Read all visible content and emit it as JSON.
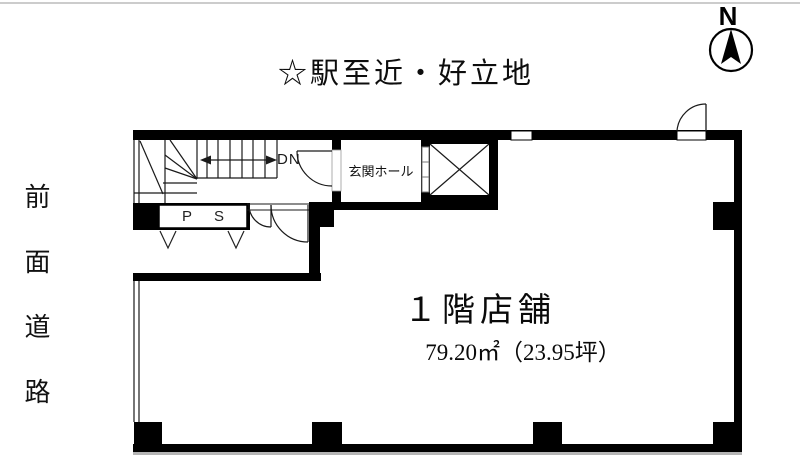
{
  "header": {
    "title": "☆駅至近・好立地"
  },
  "compass": {
    "label": "N"
  },
  "road_label": {
    "text": "前面道路"
  },
  "stairwell": {
    "direction_label": "DN",
    "pipe_space_label": "P S"
  },
  "entrance": {
    "hall_label": "玄関ホール"
  },
  "shop": {
    "name": "１階店舗",
    "area": "79.20㎡（23.95坪）"
  },
  "colors": {
    "wall": "#000000",
    "line": "#1a1a1a",
    "shadow": "#b5b5b5",
    "top_border": "#cccccc",
    "background": "#ffffff"
  }
}
